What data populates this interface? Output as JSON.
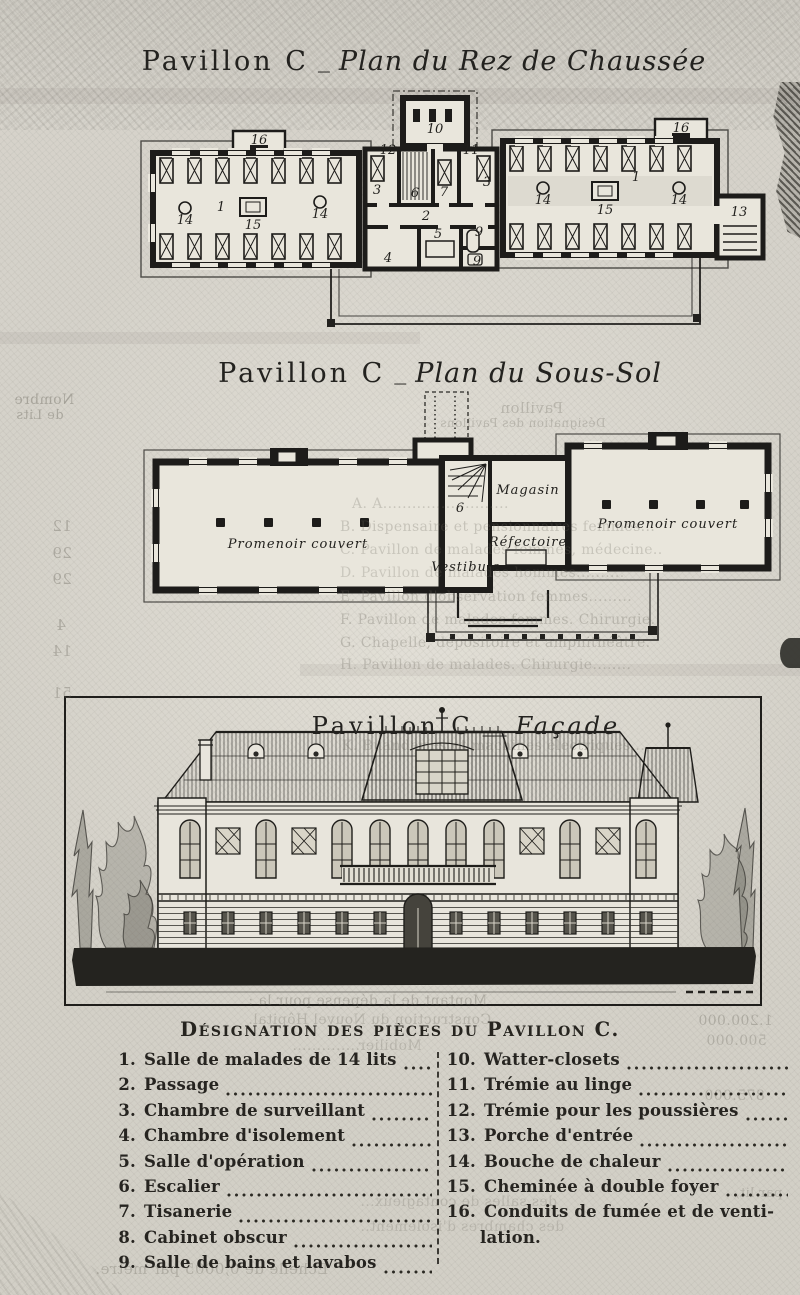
{
  "titles": {
    "rdc": {
      "prefix": "Pavillon C",
      "sep": "_",
      "name": "Plan du Rez de Chaussée"
    },
    "soussol": {
      "prefix": "Pavillon C",
      "sep": "_",
      "name": "Plan du Sous-Sol"
    },
    "facade": {
      "prefix": "Pavillon C",
      "sep": "__",
      "name": "Façade"
    }
  },
  "plans": {
    "rdc": {
      "labels": [
        {
          "t": "16",
          "x": 171,
          "y": 56
        },
        {
          "t": "16",
          "x": 593,
          "y": 44
        },
        {
          "t": "12",
          "x": 300,
          "y": 66
        },
        {
          "t": "10",
          "x": 347,
          "y": 45
        },
        {
          "t": "11",
          "x": 383,
          "y": 66
        },
        {
          "t": "3",
          "x": 289,
          "y": 106
        },
        {
          "t": "6",
          "x": 327,
          "y": 109
        },
        {
          "t": "7",
          "x": 356,
          "y": 108
        },
        {
          "t": "3",
          "x": 399,
          "y": 98
        },
        {
          "t": "2",
          "x": 338,
          "y": 132
        },
        {
          "t": "4",
          "x": 300,
          "y": 174
        },
        {
          "t": "5",
          "x": 350,
          "y": 150
        },
        {
          "t": "9",
          "x": 391,
          "y": 148
        },
        {
          "t": "9",
          "x": 389,
          "y": 177
        },
        {
          "t": "13",
          "x": 651,
          "y": 128
        },
        {
          "t": "1",
          "x": 133,
          "y": 123
        },
        {
          "t": "14",
          "x": 97,
          "y": 136
        },
        {
          "t": "15",
          "x": 165,
          "y": 141
        },
        {
          "t": "14",
          "x": 232,
          "y": 130
        },
        {
          "t": "14",
          "x": 455,
          "y": 116
        },
        {
          "t": "15",
          "x": 517,
          "y": 126
        },
        {
          "t": "1",
          "x": 548,
          "y": 93
        },
        {
          "t": "14",
          "x": 591,
          "y": 116
        }
      ]
    },
    "soussol": {
      "labels": [
        {
          "t": "Magasin",
          "x": 430,
          "y": 106,
          "st": "script"
        },
        {
          "t": "Réfectoire",
          "x": 430,
          "y": 158,
          "st": "script"
        },
        {
          "t": "Vestibule",
          "x": 368,
          "y": 183,
          "st": "script"
        },
        {
          "t": "Promenoir couvert",
          "x": 200,
          "y": 160,
          "st": "script",
          "s": 14
        },
        {
          "t": "Promenoir couvert",
          "x": 570,
          "y": 140,
          "st": "script",
          "s": 14
        },
        {
          "t": "6",
          "x": 362,
          "y": 124
        }
      ]
    }
  },
  "legend": {
    "title": "Désignation des pièces du Pavillon C.",
    "left": [
      {
        "num": "1.",
        "label": "Salle de malades de 14 lits",
        "dots": true
      },
      {
        "num": "2.",
        "label": "Passage",
        "dots": true
      },
      {
        "num": "3.",
        "label": "Chambre de surveillant",
        "dots": true
      },
      {
        "num": "4.",
        "label": "Chambre d'isolement",
        "dots": true
      },
      {
        "num": "5.",
        "label": "Salle d'opération",
        "dots": true
      },
      {
        "num": "6.",
        "label": "Escalier",
        "dots": true
      },
      {
        "num": "7.",
        "label": "Tisanerie",
        "dots": true
      },
      {
        "num": "8.",
        "label": "Cabinet obscur",
        "dots": true
      },
      {
        "num": "9.",
        "label": "Salle de bains et lavabos",
        "dots": true
      }
    ],
    "right": [
      {
        "num": "10.",
        "label": "Watter-closets",
        "dots": true
      },
      {
        "num": "11.",
        "label": "Trémie au linge",
        "dots": true
      },
      {
        "num": "12.",
        "label": "Trémie pour les poussières",
        "dots": true
      },
      {
        "num": "13.",
        "label": "Porche d'entrée",
        "dots": true
      },
      {
        "num": "14.",
        "label": "Bouche de chaleur",
        "dots": true
      },
      {
        "num": "15.",
        "label": "Cheminée à double foyer",
        "dots": true
      },
      {
        "num": "16.",
        "label": "Conduits de fumée et de venti-",
        "label2": "lation.",
        "dots": false
      }
    ]
  },
  "ghost": {
    "items": [
      {
        "t": "Nombre",
        "x": 14,
        "y": 392,
        "s": 14,
        "mir": true,
        "o": 0.42
      },
      {
        "t": "de Lits",
        "x": 16,
        "y": 408,
        "s": 13,
        "mir": true,
        "o": 0.4
      },
      {
        "t": "12",
        "x": 52,
        "y": 517,
        "s": 15,
        "mir": true,
        "o": 0.38
      },
      {
        "t": "29",
        "x": 52,
        "y": 544,
        "s": 15,
        "mir": true,
        "o": 0.38
      },
      {
        "t": "29",
        "x": 52,
        "y": 570,
        "s": 15,
        "mir": true,
        "o": 0.38
      },
      {
        "t": "4",
        "x": 56,
        "y": 616,
        "s": 15,
        "mir": true,
        "o": 0.38
      },
      {
        "t": "14",
        "x": 52,
        "y": 642,
        "s": 15,
        "mir": true,
        "o": 0.35
      },
      {
        "t": "51",
        "x": 52,
        "y": 684,
        "s": 15,
        "mir": true,
        "o": 0.35
      },
      {
        "t": "Pavillon",
        "x": 500,
        "y": 399,
        "s": 15,
        "mir": true,
        "o": 0.3
      },
      {
        "t": "Désignation des Pavillons",
        "x": 440,
        "y": 416,
        "s": 12,
        "mir": true,
        "o": 0.3
      },
      {
        "t": "A. A..........................",
        "x": 352,
        "y": 496,
        "s": 14,
        "o": 0.26
      },
      {
        "t": "B. Dispensaire et pensionnaires femmes...",
        "x": 340,
        "y": 519,
        "s": 14,
        "o": 0.28
      },
      {
        "t": "C. Pavillon de malades femmes, médecine..",
        "x": 340,
        "y": 542,
        "s": 14,
        "o": 0.26
      },
      {
        "t": "D. Pavillon de malades hommes..........",
        "x": 340,
        "y": 565,
        "s": 14,
        "o": 0.24
      },
      {
        "t": "E. Pavillon d'observation femmes.........",
        "x": 340,
        "y": 589,
        "s": 14,
        "o": 0.28
      },
      {
        "t": "F. Pavillon de malades femmes. Chirurgie.",
        "x": 340,
        "y": 612,
        "s": 14,
        "o": 0.3
      },
      {
        "t": "G. Chapelle, dépositoire et amphithéâtre.",
        "x": 340,
        "y": 635,
        "s": 14,
        "o": 0.3
      },
      {
        "t": "H. Pavillon de malades. Chirurgie........",
        "x": 340,
        "y": 657,
        "s": 14,
        "o": 0.28
      },
      {
        "t": "K. Buanderies et machines électriques...",
        "x": 342,
        "y": 738,
        "s": 14,
        "o": 0.28
      },
      {
        "t": "Montant de la dépense pour la :",
        "x": 248,
        "y": 993,
        "s": 14,
        "mir": true,
        "o": 0.34
      },
      {
        "t": "Construction du Nouvel Hôpital.",
        "x": 248,
        "y": 1012,
        "s": 14,
        "mir": true,
        "o": 0.28
      },
      {
        "t": "Mobilier..............",
        "x": 292,
        "y": 1038,
        "s": 14,
        "mir": true,
        "o": 0.26
      },
      {
        "t": "1.200.000",
        "x": 698,
        "y": 1013,
        "s": 14,
        "mir": true,
        "o": 0.34
      },
      {
        "t": "500.000",
        "x": 706,
        "y": 1033,
        "s": 14,
        "mir": true,
        "o": 0.3
      },
      {
        "t": "875.000",
        "x": 704,
        "y": 1088,
        "s": 14,
        "mir": true,
        "o": 0.3
      },
      {
        "t": "par lit,",
        "x": 735,
        "y": 1186,
        "s": 13,
        "mir": true,
        "o": 0.28
      },
      {
        "t": "des salles de contagieux...",
        "x": 360,
        "y": 1194,
        "s": 14,
        "mir": true,
        "o": 0.24
      },
      {
        "t": "des chambres d'isolement..",
        "x": 360,
        "y": 1219,
        "s": 14,
        "mir": true,
        "o": 0.24
      },
      {
        "t": "Echelle de 0,0005 par mètre.",
        "x": 95,
        "y": 1260,
        "s": 15,
        "mir": true,
        "o": 0.3
      }
    ]
  }
}
